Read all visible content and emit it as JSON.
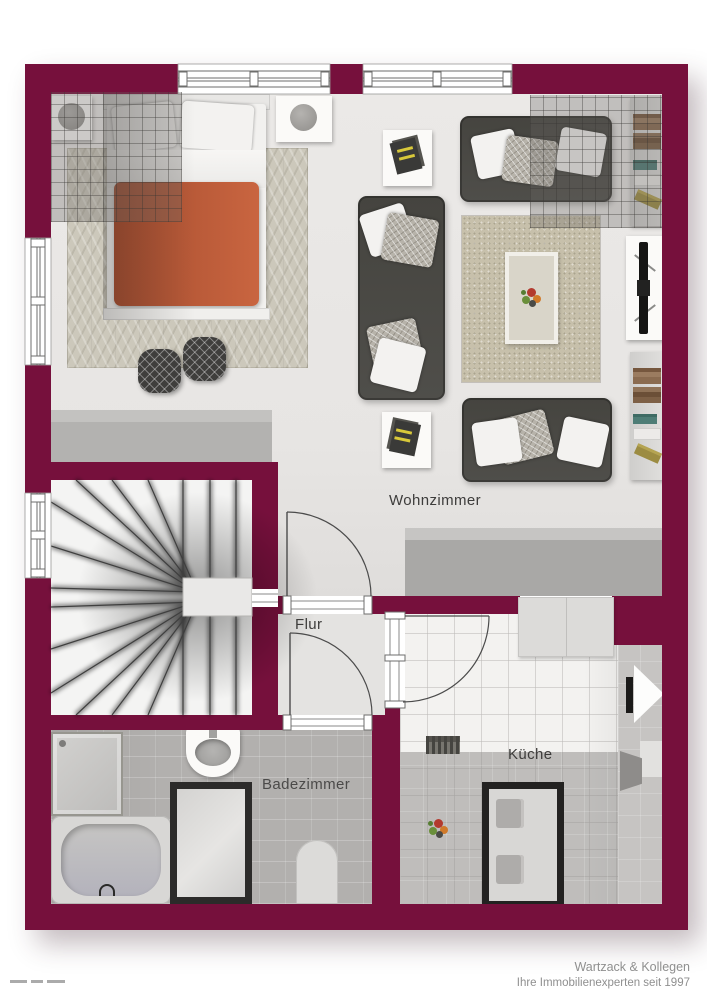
{
  "rooms": {
    "wohnzimmer": "Wohnzimmer",
    "flur": "Flur",
    "badezimmer": "Badezimmer",
    "kueche": "Küche"
  },
  "footer": {
    "company": "Wartzack & Kollegen",
    "tagline": "Ihre Immobilienexperten seit 1997"
  },
  "colors": {
    "wall": "#76103c",
    "floor_light": "#e9e7e5",
    "bedroom_carpet": "#ccc8bb",
    "bath_tile": "#b2b0ae",
    "kitchen_tile": "#f3f2f0",
    "sofa": "#4c4b48",
    "duvet_accent": "#bd5c3a",
    "rug": "#c7c0ab",
    "label_text": "#3d3c3b",
    "footer_text": "#8f8f8f"
  },
  "icons": {
    "furniture": [
      "double-bed",
      "nightstand-lamp",
      "pouf",
      "sofa",
      "rug",
      "coffee-table",
      "side-table-art",
      "tv-board",
      "bookshelf",
      "staircase",
      "window",
      "door-swing",
      "shower",
      "washbasin",
      "bathtub",
      "glass-shower-cabin",
      "bath-mat",
      "kitchen-counter",
      "kitchen-table",
      "chair",
      "radiator",
      "fruit-bowl"
    ]
  }
}
